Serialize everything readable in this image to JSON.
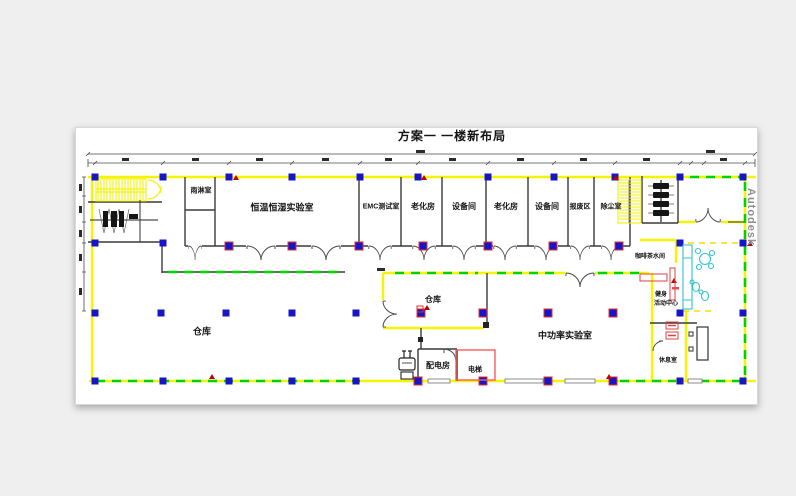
{
  "title": "方案一  一楼新布局",
  "watermark": "Autodesk",
  "palette": {
    "paper": "#ffffff",
    "desktop": "#efefef",
    "wall_yellow": "#f7f700",
    "dash_green": "#00d200",
    "column_blue": "#1616c8",
    "accent_red": "#dd2222",
    "furniture_cyan": "#2fc4cf",
    "line_dark": "#3a3a3a"
  },
  "rooms": {
    "rain_shower": "雨淋室",
    "climate_lab": "恒温恒湿实验室",
    "emc_test": "EMC测试室",
    "aging_room_1": "老化房",
    "equipment_room_1": "设备间",
    "aging_room_2": "老化房",
    "equipment_room_2": "设备间",
    "scrap_area": "报废区",
    "dust_removal": "除尘室",
    "warehouse_large": "仓库",
    "warehouse_small": "仓库",
    "power_distribution": "配电房",
    "elevator": "电梯",
    "medium_power_lab": "中功率实验室",
    "coffee_water_room": "咖啡茶水间",
    "fitness_center_line1": "健身",
    "fitness_center_line2": "活动中心",
    "rest_room": "休息室"
  }
}
